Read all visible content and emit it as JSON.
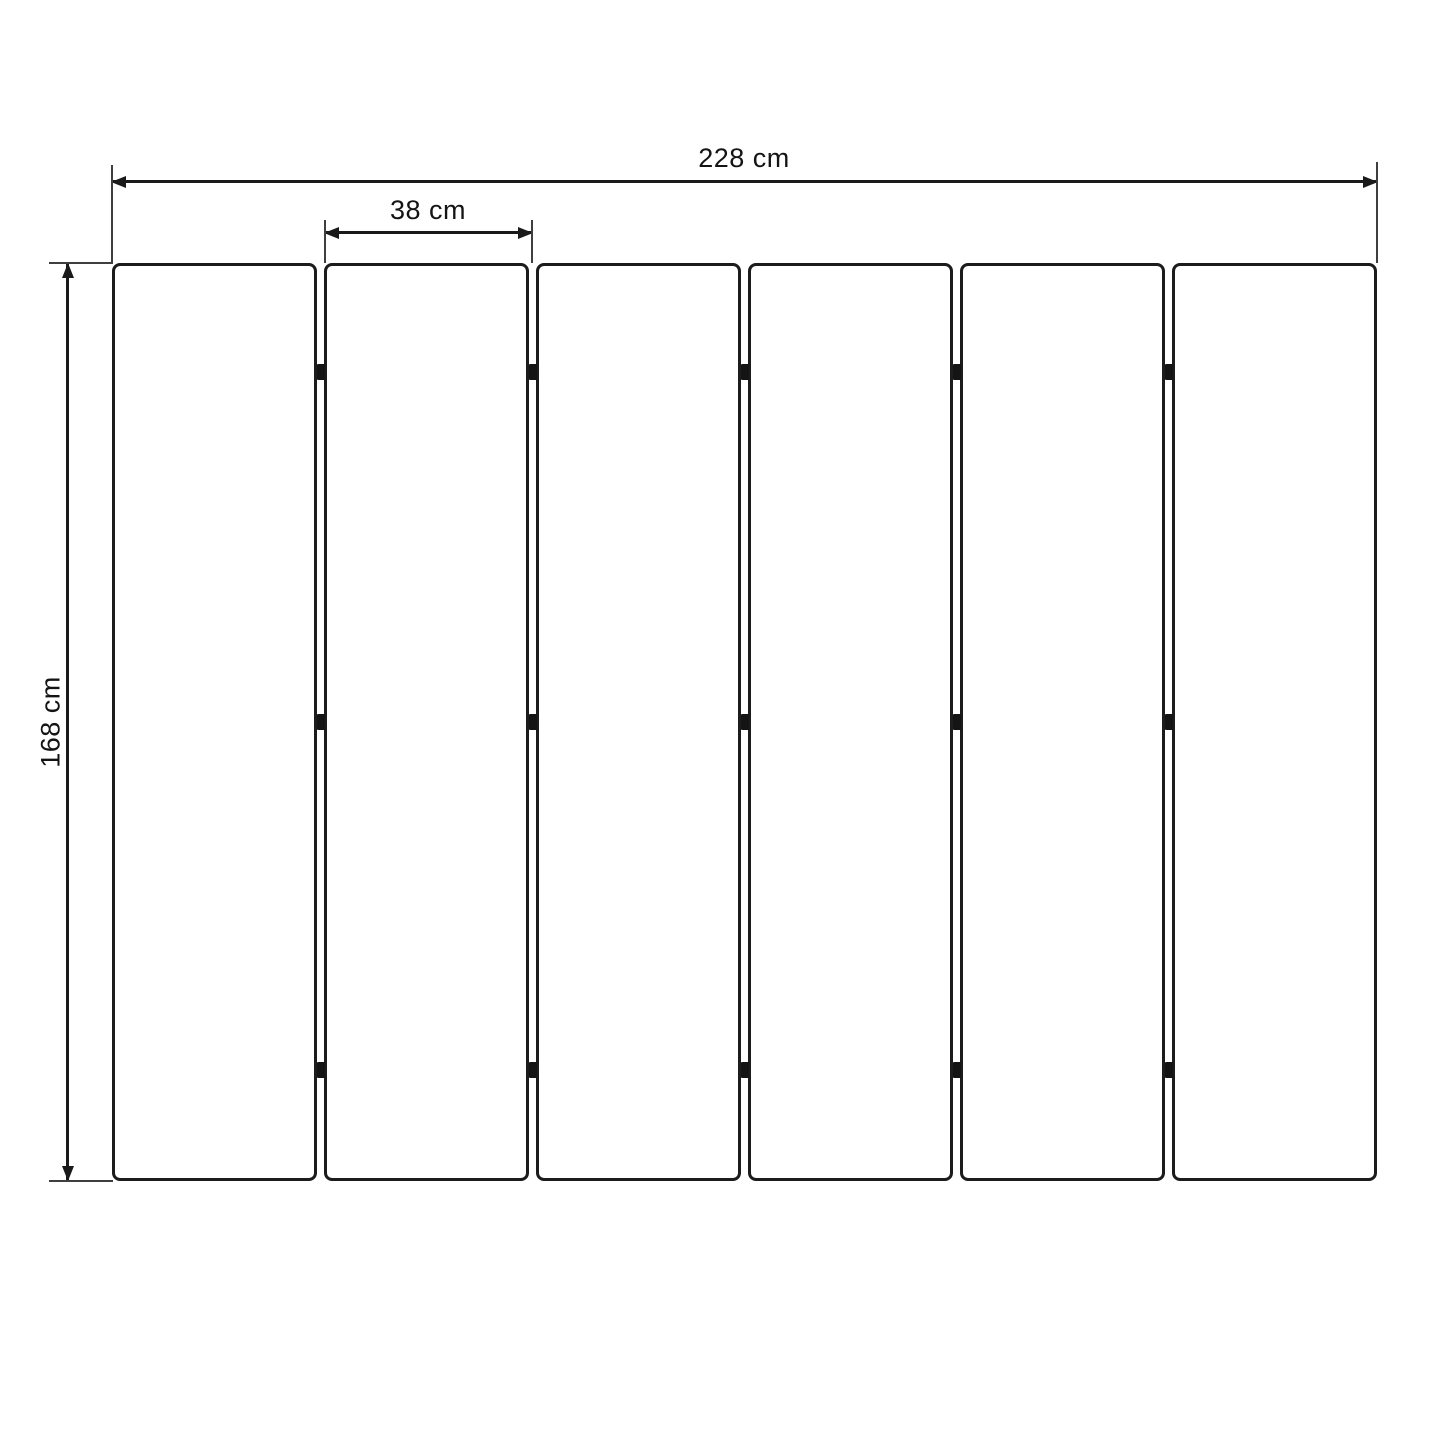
{
  "diagram": {
    "dimension_labels": {
      "total_width": "228 cm",
      "single_panel_width": "38 cm",
      "height": "168 cm"
    },
    "dimension_values": {
      "total_width_cm": 228,
      "single_panel_width_cm": 38,
      "height_cm": 168,
      "unit": "cm"
    },
    "panel_count": 6,
    "hinge_rows_per_gap": 3,
    "colors": {
      "line": "#1a1a1a",
      "extension_line": "#3f3f3f",
      "panel_border": "#1c1c1c",
      "hinge": "#141414",
      "text": "#141414",
      "background": "#ffffff",
      "panel_fill": "#ffffff"
    }
  }
}
